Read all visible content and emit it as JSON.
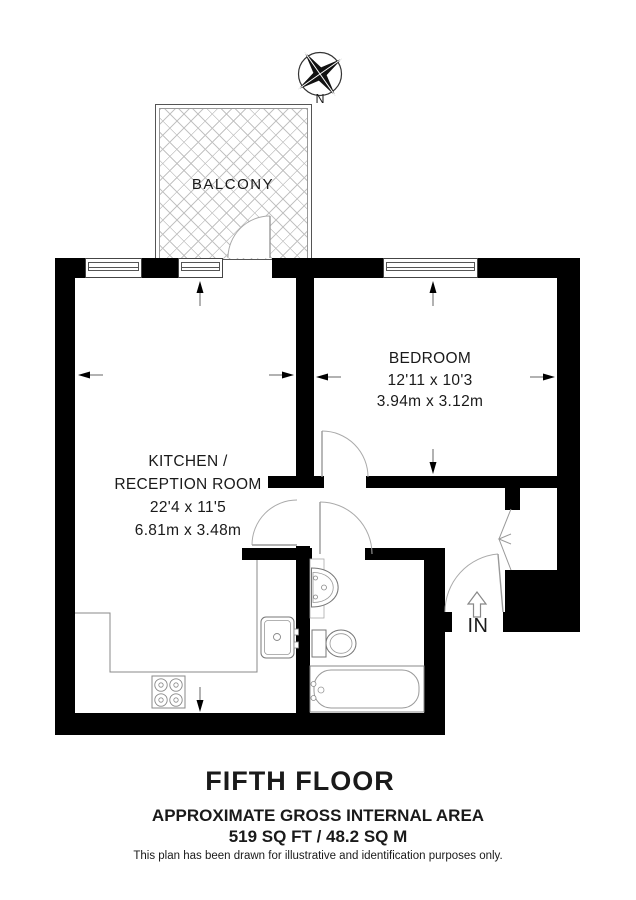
{
  "compass": {
    "north_label": "N"
  },
  "rooms": {
    "balcony": {
      "label": "BALCONY"
    },
    "kitchen_reception": {
      "label_line1": "KITCHEN /",
      "label_line2": "RECEPTION ROOM",
      "dimensions_imperial": "22'4 x 11'5",
      "dimensions_metric": "6.81m x 3.48m"
    },
    "bedroom": {
      "label": "BEDROOM",
      "dimensions_imperial": "12'11 x 10'3",
      "dimensions_metric": "3.94m x 3.12m"
    }
  },
  "entrance": {
    "label": "IN"
  },
  "title_block": {
    "floor_title": "FIFTH FLOOR",
    "area_heading": "APPROXIMATE GROSS INTERNAL AREA",
    "area_value": "519 SQ FT / 48.2 SQ M",
    "disclaimer": "This plan has been drawn for illustrative and identification purposes only."
  },
  "colors": {
    "wall": "#000000",
    "hatch_line": "#c3c3c3",
    "fixture_line": "#888888",
    "text": "#1a1a1a"
  }
}
